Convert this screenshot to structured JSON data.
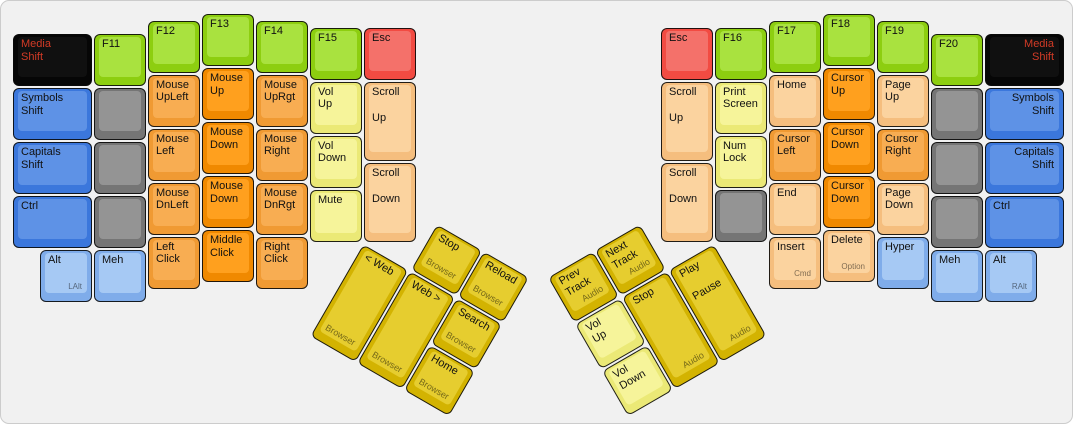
{
  "canvas": {
    "background": "#f1f1f1",
    "frame_border": "#cccccc"
  },
  "palette": {
    "green": {
      "side": "#8dce10",
      "top": "#a9e23f",
      "text": "#111111"
    },
    "orange": {
      "side": "#f09a33",
      "top": "#f8ad52",
      "text": "#111111"
    },
    "orangeDark": {
      "side": "#f08900",
      "top": "#ffa01e",
      "text": "#111111"
    },
    "peach": {
      "side": "#f5be7e",
      "top": "#fbd39f",
      "text": "#111111"
    },
    "yellow": {
      "side": "#ebe976",
      "top": "#f6f49a",
      "text": "#111111"
    },
    "gold": {
      "side": "#d3b301",
      "top": "#e6cd2f",
      "text": "#111111"
    },
    "red": {
      "side": "#f24b42",
      "top": "#f4716a",
      "text": "#111111"
    },
    "blue": {
      "side": "#3b77dc",
      "top": "#5e92e6",
      "text": "#111111"
    },
    "lightblue": {
      "side": "#7facea",
      "top": "#a6c9f4",
      "text": "#111111"
    },
    "gray": {
      "side": "#757575",
      "top": "#949494",
      "text": "#111111"
    },
    "black": {
      "side": "#060606",
      "top": "#101010",
      "text": "#d23b26"
    }
  },
  "board": {
    "unit": 54,
    "margin_x": 11,
    "margin_y": 12,
    "left_main": [
      {
        "label": "Media\nShift",
        "x": 0,
        "y": 0.375,
        "w": 1.5,
        "color": "black"
      },
      {
        "label": "Symbols\nShift",
        "x": 0,
        "y": 1.375,
        "w": 1.5,
        "color": "blue"
      },
      {
        "label": "Capitals\nShift",
        "x": 0,
        "y": 2.375,
        "w": 1.5,
        "color": "blue"
      },
      {
        "label": "Ctrl",
        "x": 0,
        "y": 3.375,
        "w": 1.5,
        "color": "blue"
      },
      {
        "label": "F11",
        "x": 1.5,
        "y": 0.375,
        "color": "green"
      },
      {
        "label": "",
        "x": 1.5,
        "y": 1.375,
        "color": "gray"
      },
      {
        "label": "",
        "x": 1.5,
        "y": 2.375,
        "color": "gray"
      },
      {
        "label": "",
        "x": 1.5,
        "y": 3.375,
        "color": "gray"
      },
      {
        "label": "Alt",
        "sub": "LAlt",
        "x": 0.5,
        "y": 4.375,
        "color": "lightblue"
      },
      {
        "label": "Meh",
        "x": 1.5,
        "y": 4.375,
        "color": "lightblue"
      },
      {
        "label": "F12",
        "x": 2.5,
        "y": 0.125,
        "color": "green"
      },
      {
        "label": "Mouse\nUpLeft",
        "x": 2.5,
        "y": 1.125,
        "color": "orange"
      },
      {
        "label": "Mouse\nLeft",
        "x": 2.5,
        "y": 2.125,
        "color": "orange"
      },
      {
        "label": "Mouse\nDnLeft",
        "x": 2.5,
        "y": 3.125,
        "color": "orange"
      },
      {
        "label": "Left\nClick",
        "x": 2.5,
        "y": 4.125,
        "color": "orange"
      },
      {
        "label": "F13",
        "x": 3.5,
        "y": 0,
        "color": "green"
      },
      {
        "label": "Mouse\nUp",
        "x": 3.5,
        "y": 1,
        "color": "orangeDark"
      },
      {
        "label": "Mouse\nDown",
        "x": 3.5,
        "y": 2,
        "color": "orangeDark"
      },
      {
        "label": "Mouse\nDown",
        "x": 3.5,
        "y": 3,
        "color": "orangeDark"
      },
      {
        "label": "Middle\nClick",
        "x": 3.5,
        "y": 4,
        "color": "orangeDark"
      },
      {
        "label": "F14",
        "x": 4.5,
        "y": 0.125,
        "color": "green"
      },
      {
        "label": "Mouse\nUpRgt",
        "x": 4.5,
        "y": 1.125,
        "color": "orange"
      },
      {
        "label": "Mouse\nRight",
        "x": 4.5,
        "y": 2.125,
        "color": "orange"
      },
      {
        "label": "Mouse\nDnRgt",
        "x": 4.5,
        "y": 3.125,
        "color": "orange"
      },
      {
        "label": "Right\nClick",
        "x": 4.5,
        "y": 4.125,
        "color": "orange"
      },
      {
        "label": "F15",
        "x": 5.5,
        "y": 0.25,
        "color": "green"
      },
      {
        "label": "Vol\nUp",
        "x": 5.5,
        "y": 1.25,
        "color": "yellow"
      },
      {
        "label": "Vol\nDown",
        "x": 5.5,
        "y": 2.25,
        "color": "yellow"
      },
      {
        "label": "Mute",
        "x": 5.5,
        "y": 3.25,
        "color": "yellow"
      },
      {
        "label": "Esc",
        "x": 6.5,
        "y": 0.25,
        "color": "red"
      },
      {
        "label": "Scroll",
        "mid": "Up",
        "x": 6.5,
        "y": 1.25,
        "h": 1.5,
        "color": "peach"
      },
      {
        "label": "Scroll",
        "mid": "Down",
        "x": 6.5,
        "y": 2.75,
        "h": 1.5,
        "color": "peach"
      }
    ],
    "right_main": [
      {
        "label": "Esc",
        "x": 12,
        "y": 0.25,
        "color": "red"
      },
      {
        "label": "Scroll",
        "mid": "Up",
        "x": 12,
        "y": 1.25,
        "h": 1.5,
        "color": "peach"
      },
      {
        "label": "Scroll",
        "mid": "Down",
        "x": 12,
        "y": 2.75,
        "h": 1.5,
        "color": "peach"
      },
      {
        "label": "F16",
        "x": 13,
        "y": 0.25,
        "color": "green"
      },
      {
        "label": "Print\nScreen",
        "x": 13,
        "y": 1.25,
        "color": "yellow"
      },
      {
        "label": "Num\nLock",
        "x": 13,
        "y": 2.25,
        "color": "yellow"
      },
      {
        "label": "",
        "x": 13,
        "y": 3.25,
        "color": "gray"
      },
      {
        "label": "F17",
        "x": 14,
        "y": 0.125,
        "color": "green"
      },
      {
        "label": "Home",
        "x": 14,
        "y": 1.125,
        "color": "peach"
      },
      {
        "label": "Cursor\nLeft",
        "x": 14,
        "y": 2.125,
        "color": "orange"
      },
      {
        "label": "End",
        "x": 14,
        "y": 3.125,
        "color": "peach"
      },
      {
        "label": "Insert",
        "sub": "Cmd",
        "x": 14,
        "y": 4.125,
        "color": "peach"
      },
      {
        "label": "F18",
        "x": 15,
        "y": 0,
        "color": "green"
      },
      {
        "label": "Cursor\nUp",
        "x": 15,
        "y": 1,
        "color": "orangeDark"
      },
      {
        "label": "Cursor\nDown",
        "x": 15,
        "y": 2,
        "color": "orangeDark"
      },
      {
        "label": "Cursor\nDown",
        "x": 15,
        "y": 3,
        "color": "orangeDark"
      },
      {
        "label": "Delete",
        "sub": "Option",
        "x": 15,
        "y": 4,
        "color": "peach"
      },
      {
        "label": "F19",
        "x": 16,
        "y": 0.125,
        "color": "green"
      },
      {
        "label": "Page\nUp",
        "x": 16,
        "y": 1.125,
        "color": "peach"
      },
      {
        "label": "Cursor\nRight",
        "x": 16,
        "y": 2.125,
        "color": "orange"
      },
      {
        "label": "Page\nDown",
        "x": 16,
        "y": 3.125,
        "color": "peach"
      },
      {
        "label": "Hyper",
        "x": 16,
        "y": 4.125,
        "color": "lightblue"
      },
      {
        "label": "F20",
        "x": 17,
        "y": 0.375,
        "color": "green"
      },
      {
        "label": "",
        "x": 17,
        "y": 1.375,
        "color": "gray"
      },
      {
        "label": "",
        "x": 17,
        "y": 2.375,
        "color": "gray"
      },
      {
        "label": "",
        "x": 17,
        "y": 3.375,
        "color": "gray"
      },
      {
        "label": "Meh",
        "x": 17,
        "y": 4.375,
        "color": "lightblue"
      },
      {
        "label": "Media\nShift",
        "x": 18,
        "y": 0.375,
        "w": 1.5,
        "color": "black",
        "align": "right"
      },
      {
        "label": "Symbols\nShift",
        "x": 18,
        "y": 1.375,
        "w": 1.5,
        "color": "blue",
        "align": "right"
      },
      {
        "label": "Capitals\nShift",
        "x": 18,
        "y": 2.375,
        "w": 1.5,
        "color": "blue",
        "align": "right"
      },
      {
        "label": "Ctrl",
        "x": 18,
        "y": 3.375,
        "w": 1.5,
        "color": "blue"
      },
      {
        "label": "Alt",
        "sub": "RAlt",
        "x": 18,
        "y": 4.375,
        "color": "lightblue"
      }
    ],
    "left_thumb": {
      "rotation_deg": 30,
      "origin_x_u": 6.5,
      "origin_y_u": 4.25,
      "keys": [
        {
          "label": "Stop",
          "sub": "Browser",
          "sub_align": "left",
          "x": 1,
          "y": -1,
          "color": "gold"
        },
        {
          "label": "Reload",
          "sub": "Browser",
          "sub_align": "left",
          "x": 2,
          "y": -1,
          "color": "gold"
        },
        {
          "label": "< Web",
          "sub": "Browser",
          "sub_align": "left",
          "x": 0,
          "y": 0,
          "h": 2,
          "color": "gold"
        },
        {
          "label": "Web >",
          "sub": "Browser",
          "sub_align": "left",
          "x": 1,
          "y": 0,
          "h": 2,
          "color": "gold"
        },
        {
          "label": "Search",
          "sub": "Browser",
          "sub_align": "left",
          "x": 2,
          "y": 0,
          "color": "gold"
        },
        {
          "label": "Home",
          "sub": "Browser",
          "sub_align": "left",
          "x": 2,
          "y": 1,
          "color": "gold"
        }
      ]
    },
    "right_thumb": {
      "rotation_deg": -30,
      "origin_x_u": 13,
      "origin_y_u": 4.25,
      "keys": [
        {
          "label": "Prev\nTrack",
          "sub": "Audio",
          "x": -3,
          "y": -1,
          "color": "gold"
        },
        {
          "label": "Next\nTrack",
          "sub": "Audio",
          "x": -2,
          "y": -1,
          "color": "gold"
        },
        {
          "label": "Vol\nUp",
          "x": -3,
          "y": 0,
          "color": "yellow"
        },
        {
          "label": "Stop",
          "sub": "Audio",
          "x": -2,
          "y": 0,
          "h": 2,
          "color": "gold"
        },
        {
          "label": "Play",
          "mid": "Pause",
          "sub": "Audio",
          "x": -1,
          "y": 0,
          "h": 2,
          "color": "gold"
        },
        {
          "label": "Vol\nDown",
          "x": -3,
          "y": 1,
          "color": "yellow"
        }
      ]
    }
  }
}
